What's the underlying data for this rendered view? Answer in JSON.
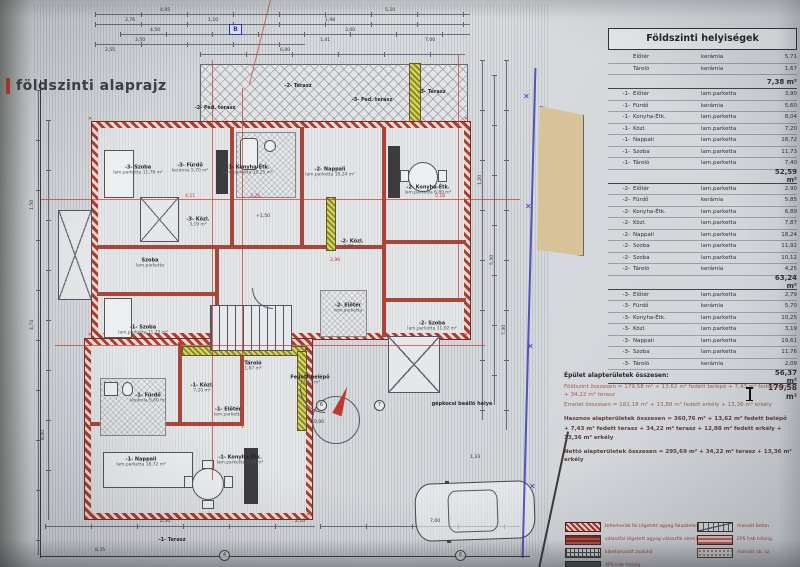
{
  "plan": {
    "title": "földszinti alaprajz",
    "marker_b": "B",
    "labels": [
      {
        "t": "-3- Szoba",
        "s": "lam.parketta 11,76 m²",
        "x": 138,
        "y": 170
      },
      {
        "t": "-3- Fürdő",
        "s": "kerámia 5,70 m²",
        "x": 190,
        "y": 168
      },
      {
        "t": "-3- Konyha-Étk.",
        "s": "lam.parketta 10,25 m²",
        "x": 248,
        "y": 170
      },
      {
        "t": "-2- Nappali",
        "s": "lam.parketta 18,24 m²",
        "x": 330,
        "y": 172
      },
      {
        "t": "-2- Konyha-Étk.",
        "s": "lam.parketta 6,89 m²",
        "x": 428,
        "y": 190
      },
      {
        "t": "-3- Közl.",
        "s": "3,19 m²",
        "x": 198,
        "y": 222
      },
      {
        "t": "-2- Közl.",
        "s": "7,87 m²",
        "x": 352,
        "y": 244
      },
      {
        "t": "Szoba",
        "s": "lam.parketta",
        "x": 150,
        "y": 263
      },
      {
        "t": "-1- Szoba",
        "s": "lam.parketta 11,73 m²",
        "x": 143,
        "y": 330
      },
      {
        "t": "-2- Szoba",
        "s": "lam.parketta 11,92 m²",
        "x": 432,
        "y": 326
      },
      {
        "t": "Tároló",
        "s": "1,67 m²",
        "x": 253,
        "y": 366
      },
      {
        "t": "-2- Előtér",
        "s": "lam.parketta",
        "x": 348,
        "y": 308
      },
      {
        "t": "-1- Közl.",
        "s": "7,20 m²",
        "x": 202,
        "y": 388
      },
      {
        "t": "-1- Fürdő",
        "s": "kerámia 5,60 m²",
        "x": 148,
        "y": 398
      },
      {
        "t": "-1- Előtér",
        "s": "lam.parketta",
        "x": 228,
        "y": 412
      },
      {
        "t": "-1- Nappali",
        "s": "lam.parketta 18,72 m²",
        "x": 141,
        "y": 462
      },
      {
        "t": "-1- Konyha-Étk.",
        "s": "lam.parketta 8,04 m²",
        "x": 240,
        "y": 460
      },
      {
        "t": "-2- Fed. terasz",
        "s": "",
        "x": 215,
        "y": 108
      },
      {
        "t": "-2- Terasz",
        "s": "",
        "x": 298,
        "y": 86
      },
      {
        "t": "-3- Fed. terasz",
        "s": "",
        "x": 372,
        "y": 100
      },
      {
        "t": "-3- Terasz",
        "s": "",
        "x": 432,
        "y": 92
      },
      {
        "t": "-1- Terasz",
        "s": "",
        "x": 172,
        "y": 540
      },
      {
        "t": "Fedett belépő",
        "s": "13,62 m²",
        "x": 310,
        "y": 380
      },
      {
        "t": "gépkocsi beálló helye",
        "s": "",
        "x": 462,
        "y": 404
      }
    ],
    "dims": [
      {
        "t": "4,95",
        "x": 160,
        "y": 8
      },
      {
        "t": "5,10",
        "x": 385,
        "y": 8
      },
      {
        "t": "2,76",
        "x": 125,
        "y": 18
      },
      {
        "t": "1,10",
        "x": 208,
        "y": 18
      },
      {
        "t": "1,98",
        "x": 325,
        "y": 18
      },
      {
        "t": "4,50",
        "x": 150,
        "y": 28
      },
      {
        "t": "3,00",
        "x": 345,
        "y": 28
      },
      {
        "t": "3,50",
        "x": 135,
        "y": 38
      },
      {
        "t": "1,41",
        "x": 320,
        "y": 38
      },
      {
        "t": "7,00",
        "x": 425,
        "y": 38
      },
      {
        "t": "2,55",
        "x": 105,
        "y": 48
      },
      {
        "t": "6,00",
        "x": 280,
        "y": 48
      },
      {
        "t": "4,11",
        "x": 185,
        "y": 194,
        "cls": "red"
      },
      {
        "t": "3,26",
        "x": 250,
        "y": 194,
        "cls": "red"
      },
      {
        "t": "5,18",
        "x": 435,
        "y": 194,
        "cls": "red"
      },
      {
        "t": "2,90",
        "x": 330,
        "y": 258,
        "cls": "red"
      },
      {
        "t": "+1,50",
        "x": 256,
        "y": 214
      },
      {
        "t": "±0,00",
        "x": 310,
        "y": 420
      },
      {
        "t": "1,50",
        "x": 30,
        "y": 210,
        "r": -90
      },
      {
        "t": "4,74",
        "x": 30,
        "y": 330,
        "r": -90
      },
      {
        "t": "8,00",
        "x": 41,
        "y": 440,
        "r": -90
      },
      {
        "t": "1,20",
        "x": 478,
        "y": 185,
        "r": -90
      },
      {
        "t": "5,30",
        "x": 490,
        "y": 265,
        "r": -90
      },
      {
        "t": "7,30",
        "x": 502,
        "y": 335,
        "r": -90
      },
      {
        "t": "1,33",
        "x": 470,
        "y": 455
      },
      {
        "t": "2,50",
        "x": 160,
        "y": 519
      },
      {
        "t": "2,10",
        "x": 295,
        "y": 519
      },
      {
        "t": "7,00",
        "x": 430,
        "y": 519
      },
      {
        "t": "8,35",
        "x": 95,
        "y": 548
      }
    ],
    "bubbles": [
      {
        "t": "6",
        "x": 316,
        "y": 400
      },
      {
        "t": "7",
        "x": 374,
        "y": 400
      },
      {
        "t": "4",
        "x": 219,
        "y": 550
      },
      {
        "t": "8",
        "x": 455,
        "y": 550
      }
    ]
  },
  "rooms_table": {
    "title": "Földszinti helyiségek",
    "rows": [
      {
        "p": "",
        "n": "Előtér",
        "m": "kerámia",
        "a": "5,71",
        "cls": "r"
      },
      {
        "p": "",
        "n": "Tároló",
        "m": "kerámia",
        "a": "1,67",
        "cls": "r"
      },
      {
        "p": "",
        "n": "",
        "m": "",
        "a": "7,38 m²",
        "cls": "sub"
      },
      {
        "p": "-1-",
        "n": "Előtér",
        "m": "lam.parketta",
        "a": "3,90",
        "cls": "r"
      },
      {
        "p": "-1-",
        "n": "Fürdő",
        "m": "kerámia",
        "a": "5,60",
        "cls": "r"
      },
      {
        "p": "-1-",
        "n": "Konyha-Étk.",
        "m": "lam.parketta",
        "a": "8,04",
        "cls": "r"
      },
      {
        "p": "-1-",
        "n": "Közl.",
        "m": "lam.parketta",
        "a": "7,20",
        "cls": "r"
      },
      {
        "p": "-1-",
        "n": "Nappali",
        "m": "lam.parketta",
        "a": "18,72",
        "cls": "r"
      },
      {
        "p": "-1-",
        "n": "Szoba",
        "m": "lam.parketta",
        "a": "11,73",
        "cls": "r"
      },
      {
        "p": "-1-",
        "n": "Tároló",
        "m": "lam.parketta",
        "a": "7,40",
        "cls": "r"
      },
      {
        "p": "",
        "n": "",
        "m": "",
        "a": "52,59 m²",
        "cls": "sub"
      },
      {
        "p": "-2-",
        "n": "Előtér",
        "m": "lam.parketta",
        "a": "2,90",
        "cls": "r"
      },
      {
        "p": "-2-",
        "n": "Fürdő",
        "m": "kerámia",
        "a": "5,85",
        "cls": "r"
      },
      {
        "p": "-2-",
        "n": "Konyha-Étk.",
        "m": "lam.parketta",
        "a": "6,89",
        "cls": "r"
      },
      {
        "p": "-2-",
        "n": "Közl.",
        "m": "lam.parketta",
        "a": "7,87",
        "cls": "r"
      },
      {
        "p": "-2-",
        "n": "Nappali",
        "m": "lam.parketta",
        "a": "18,24",
        "cls": "r"
      },
      {
        "p": "-2-",
        "n": "Szoba",
        "m": "lam.parketta",
        "a": "11,92",
        "cls": "r"
      },
      {
        "p": "-2-",
        "n": "Szoba",
        "m": "lam.parketta",
        "a": "10,12",
        "cls": "r"
      },
      {
        "p": "-2-",
        "n": "Tároló",
        "m": "kerámia",
        "a": "4,25",
        "cls": "r"
      },
      {
        "p": "",
        "n": "",
        "m": "",
        "a": "63,24 m²",
        "cls": "sub"
      },
      {
        "p": "-3-",
        "n": "Előtér",
        "m": "lam.parketta",
        "a": "2,79",
        "cls": "r"
      },
      {
        "p": "-3-",
        "n": "Fürdő",
        "m": "kerámia",
        "a": "5,70",
        "cls": "r"
      },
      {
        "p": "-3-",
        "n": "Konyha-Étk.",
        "m": "lam.parketta",
        "a": "10,25",
        "cls": "r"
      },
      {
        "p": "-3-",
        "n": "Közl.",
        "m": "lam.parketta",
        "a": "3,19",
        "cls": "r"
      },
      {
        "p": "-3-",
        "n": "Nappali",
        "m": "lam.parketta",
        "a": "19,61",
        "cls": "r"
      },
      {
        "p": "-3-",
        "n": "Szoba",
        "m": "lam.parketta",
        "a": "11,76",
        "cls": "r"
      },
      {
        "p": "-3-",
        "n": "Tároló",
        "m": "kerámia",
        "a": "2,09",
        "cls": "r"
      },
      {
        "p": "",
        "n": "",
        "m": "",
        "a": "56,37 m²",
        "cls": "sub"
      },
      {
        "p": "",
        "n": "",
        "m": "",
        "a": "179,58 m²",
        "cls": "total"
      }
    ]
  },
  "summary": {
    "heading": "Épület alapterületek összesen:",
    "lines": [
      {
        "t": "Földszint összesen = 179,58 m² + 13,62 m² fedett belépő + 7,43 m² fedett terasz + 34,22 m² terasz",
        "cls": "red"
      },
      {
        "t": "Emelet összesen = 181,18 m² + 13,88 m² fedett erkély + 13,36 m² erkély",
        "cls": "red"
      },
      {
        "t": "Hasznos alapterületek összesen = 360,76 m² + 13,62 m² fedett belépő",
        "cls": "dark gap"
      },
      {
        "t": "+ 7,43 m² fedett terasz + 34,22 m² terasz + 12,88 m² fedett erkély + 13,36 m² erkély",
        "cls": "dark"
      },
      {
        "t": "Nettó alapterületek összesen = 295,69 m² + 34,22 m² terasz + 13,36 m² erkély",
        "cls": "dark gap"
      }
    ]
  },
  "legend": {
    "left": [
      {
        "label": "teherhordó fal (égetett agyag falazóelem)",
        "cls": "sw-brick"
      },
      {
        "label": "válaszfal (égetett agyag válaszfal elem)",
        "cls": "sw-solid"
      },
      {
        "label": "kibetonozott zsalukő",
        "cls": "sw-grid"
      },
      {
        "label": "XPS hab hőszig.",
        "cls": "sw-dark"
      }
    ],
    "right": [
      {
        "label": "monolit beton",
        "cls": "sw-cross"
      },
      {
        "label": "EPS hab hőszig.",
        "cls": "sw-eps"
      },
      {
        "label": "monolit vb. sz.",
        "cls": "sw-dots"
      }
    ]
  }
}
